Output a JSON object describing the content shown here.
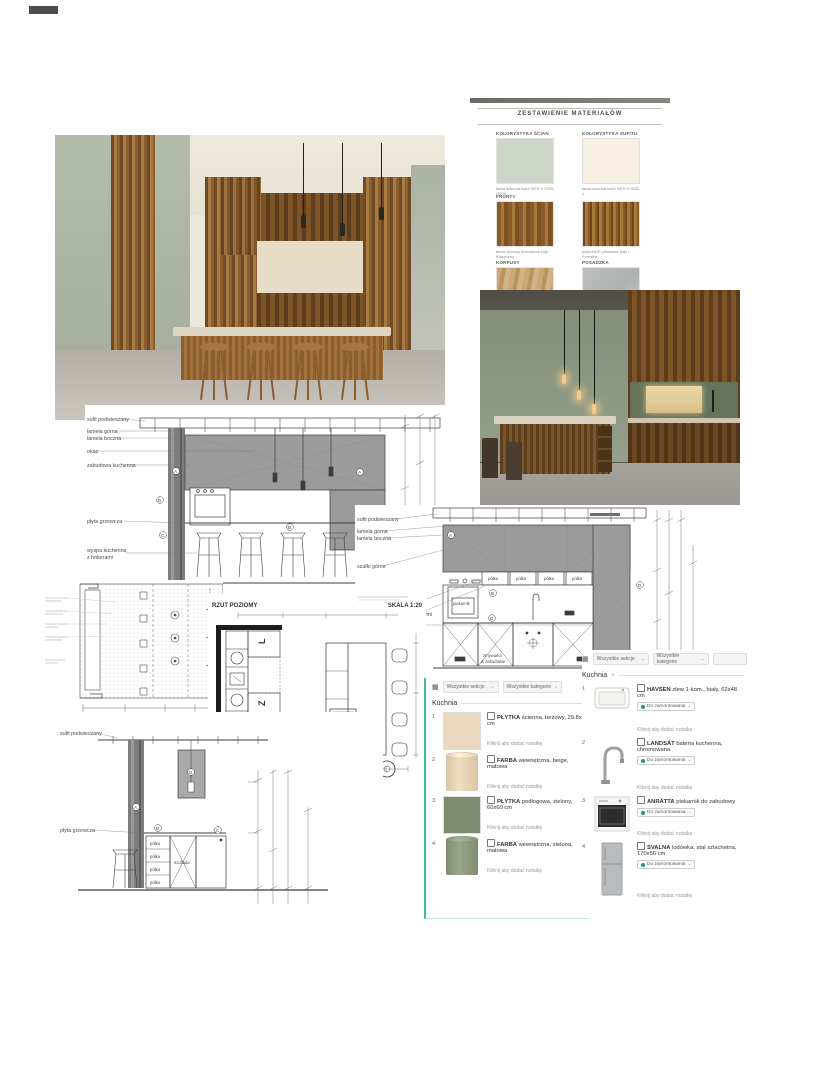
{
  "icons": {
    "grid": "▦",
    "chevron": "⌄",
    "plus": "+"
  },
  "materials_board": {
    "title": "ZESTAWIENIE MATERIAŁÓW",
    "rows": [
      {
        "left": {
          "label": "KOLORYSTYKA ŚCIAN",
          "caption": "farba ścienna kolor NCS S 2005-G20Y"
        },
        "right": {
          "label": "KOLORYSTYKA SUFITU",
          "caption": "farba ścienna kolor NCS S 0502-Y"
        }
      },
      {
        "left": {
          "label": "FRONTY",
          "caption": "fornir dębowy Woodwork Dąb Klasyczny"
        },
        "right": {
          "label": "",
          "caption": "płyta MDF ryflowana Dąb / Forestile"
        }
      },
      {
        "left": {
          "label": "KORPUSY",
          "caption": ""
        },
        "right": {
          "label": "POSADZKA",
          "caption": ""
        }
      }
    ]
  },
  "drawings": {
    "elev1": {
      "labels": [
        "sufit podwieszany",
        "lamela górna",
        "lamela boczna",
        "okap",
        "zabudowa kuchenna",
        "płyta grzewcza",
        "wyspa kuchenna",
        "z hokerami"
      ],
      "markers": [
        "A",
        "A",
        "D",
        "B",
        "C"
      ]
    },
    "elev2": {
      "labels": [
        "sufit podwieszany",
        "lamela górna",
        "lamela boczna",
        "szafki górne",
        "szafki wiszące we wnęce",
        "LED L* pod szafkami wiszącymi",
        "lodówka w zabudowie"
      ],
      "shelf": "półka",
      "oven": "piekarnik",
      "dishwasher_line1": "zmywarka",
      "dishwasher_line2": "w zabudowie",
      "markers": [
        "A",
        "B",
        "B",
        "D"
      ]
    },
    "plan": {
      "title": "RZUT POZIOMY",
      "scale": "SKALA 1:20",
      "letters": [
        "L",
        "Z",
        "P"
      ]
    },
    "island": {
      "labels": [
        "sufit podwieszany",
        "płyta grzewcza"
      ],
      "shelf": "półka",
      "drawer": "szuflada",
      "markers": [
        "A",
        "B",
        "C",
        "D"
      ]
    }
  },
  "left_panel": {
    "filter_sections": "Wszystkie sekcje",
    "filter_categories": "Wszystkie kategorie",
    "heading": "Kuchnia",
    "note": "Kliknij aby dodać notatkę",
    "items": [
      {
        "num": "1",
        "name": "PŁYTKA",
        "desc": "ścienna, beżowy, 29.8x60 cm"
      },
      {
        "num": "2",
        "name": "FARBA",
        "desc": "wewnętrzna, beige, matowa"
      },
      {
        "num": "3",
        "name": "PŁYTKA",
        "desc": "podłogowa, zielony, 60x60 cm"
      },
      {
        "num": "4",
        "name": "FARBA",
        "desc": "wewnętrzna, zielona, matowa"
      }
    ]
  },
  "right_panel": {
    "filter_sections": "Wszystkie sekcje",
    "filter_categories": "Wszystkie kategorie",
    "heading": "Kuchnia",
    "heading_suffix": "+",
    "status": "Do zamontowania",
    "note": "Kliknij aby dodać notatkę",
    "items": [
      {
        "num": "1",
        "name": "HAVSEN",
        "desc": "zlew 1-kom., biały, 62x48 cm"
      },
      {
        "num": "2",
        "name": "LANDSÅT",
        "desc": "bateria kuchenna, chromowana"
      },
      {
        "num": "3",
        "name": "ANRÄTTA",
        "desc": "piekarnik do zabudowy"
      },
      {
        "num": "4",
        "name": "SVALNA",
        "desc": "lodówka, stal szlachetna, 170x56 cm"
      }
    ]
  }
}
